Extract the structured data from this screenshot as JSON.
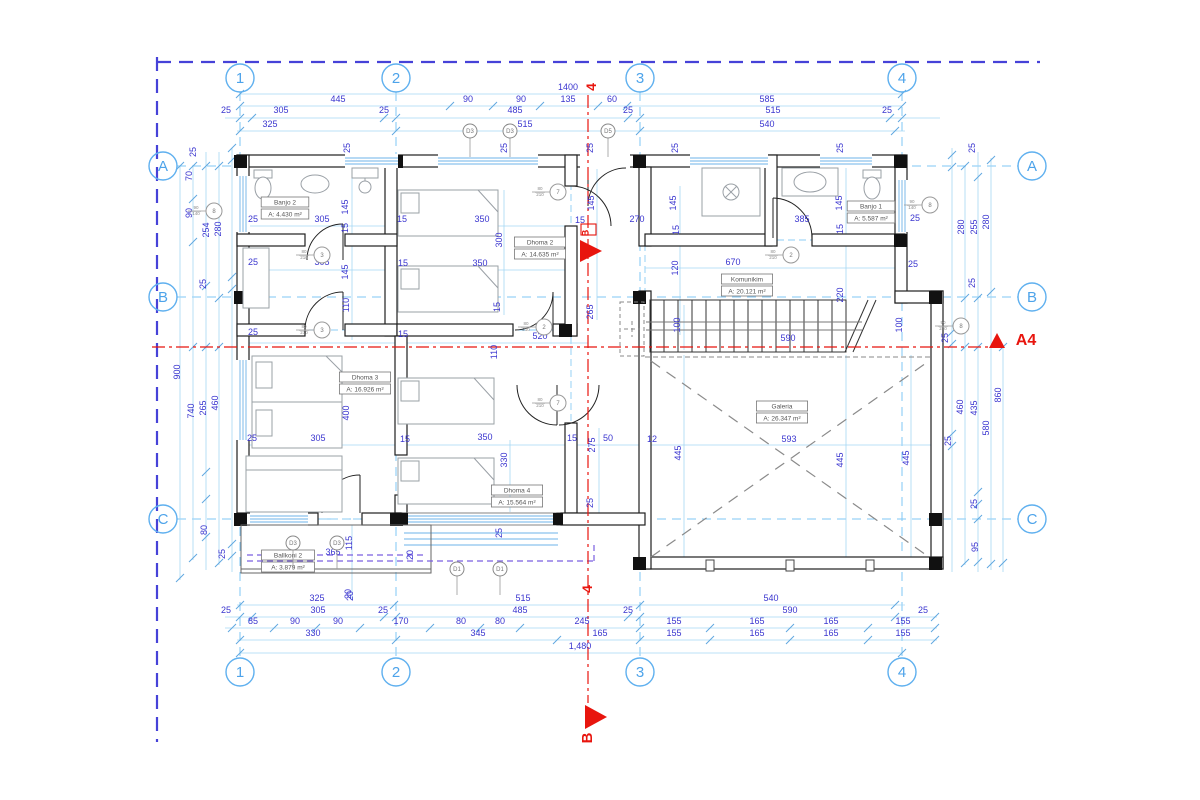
{
  "title": "First floor plan",
  "colors": {
    "dim_text": "#3a35cf",
    "grid_blue": "#5fb0ef",
    "light_blue": "#a5d7f4",
    "frame_blue": "#4642d8",
    "red": "#e8150e",
    "wall": "#1f1f1f",
    "furniture_gray": "#9aa0a6",
    "glass_blue": "#6db3e8",
    "balcony_purple": "#7a5fe0",
    "label_gray": "#555555"
  },
  "grid": {
    "cols": [
      {
        "label": "1",
        "x": 240
      },
      {
        "label": "2",
        "x": 396
      },
      {
        "label": "3",
        "x": 640
      },
      {
        "label": "4",
        "x": 902
      }
    ],
    "rows": [
      {
        "label": "A",
        "y": 166
      },
      {
        "label": "B",
        "y": 297
      },
      {
        "label": "C",
        "y": 519
      }
    ]
  },
  "rooms": [
    {
      "name": "Banjo 2",
      "area": "A: 4.430 m²",
      "cx": 285,
      "cy": 208
    },
    {
      "name": "Dhoma 2",
      "area": "A: 14.635 m²",
      "cx": 540,
      "cy": 248
    },
    {
      "name": "Banjo 1",
      "area": "A: 5.587 m²",
      "cx": 871,
      "cy": 212
    },
    {
      "name": "Komunikim",
      "area": "A: 20.121 m²",
      "cx": 747,
      "cy": 285
    },
    {
      "name": "Dhoma 3",
      "area": "A: 16.926 m²",
      "cx": 365,
      "cy": 383
    },
    {
      "name": "Dhoma 4",
      "area": "A: 15.564 m²",
      "cx": 517,
      "cy": 496
    },
    {
      "name": "Galeria",
      "area": "A: 26.347 m²",
      "cx": 782,
      "cy": 412
    },
    {
      "name": "Ballkoni 2",
      "area": "A: 3.879 m²",
      "cx": 288,
      "cy": 561
    }
  ],
  "dims": [
    [
      "1400",
      568,
      90,
      0
    ],
    [
      "445",
      338,
      102,
      0
    ],
    [
      "90",
      468,
      102,
      0
    ],
    [
      "90",
      521,
      102,
      0
    ],
    [
      "135",
      568,
      102,
      0
    ],
    [
      "60",
      612,
      102,
      0
    ],
    [
      "585",
      767,
      102,
      0
    ],
    [
      "25",
      226,
      113,
      0
    ],
    [
      "305",
      281,
      113,
      0
    ],
    [
      "25",
      384,
      113,
      0
    ],
    [
      "485",
      515,
      113,
      0
    ],
    [
      "25",
      628,
      113,
      0
    ],
    [
      "515",
      773,
      113,
      0
    ],
    [
      "25",
      887,
      113,
      0
    ],
    [
      "325",
      270,
      127,
      0
    ],
    [
      "515",
      525,
      127,
      0
    ],
    [
      "540",
      767,
      127,
      0
    ],
    [
      "25",
      350,
      148,
      1
    ],
    [
      "25",
      507,
      148,
      1
    ],
    [
      "25",
      593,
      148,
      1
    ],
    [
      "25",
      678,
      148,
      1
    ],
    [
      "25",
      843,
      148,
      1
    ],
    [
      "25",
      975,
      148,
      1
    ],
    [
      "25",
      196,
      152,
      1
    ],
    [
      "70",
      192,
      176,
      1
    ],
    [
      "90",
      192,
      213,
      1
    ],
    [
      "254",
      209,
      230,
      1
    ],
    [
      "280",
      221,
      229,
      1
    ],
    [
      "25",
      206,
      284,
      1
    ],
    [
      "900",
      180,
      372,
      1
    ],
    [
      "740",
      194,
      411,
      1
    ],
    [
      "265",
      206,
      408,
      1
    ],
    [
      "460",
      218,
      403,
      1
    ],
    [
      "80",
      207,
      530,
      1
    ],
    [
      "25",
      225,
      554,
      1
    ],
    [
      "280",
      964,
      227,
      1
    ],
    [
      "255",
      977,
      227,
      1
    ],
    [
      "280",
      989,
      222,
      1
    ],
    [
      "25",
      975,
      283,
      1
    ],
    [
      "100",
      902,
      325,
      1
    ],
    [
      "25",
      948,
      338,
      1
    ],
    [
      "860",
      1001,
      395,
      1
    ],
    [
      "460",
      963,
      407,
      1
    ],
    [
      "435",
      977,
      408,
      1
    ],
    [
      "580",
      989,
      428,
      1
    ],
    [
      "25",
      951,
      441,
      1
    ],
    [
      "25",
      977,
      504,
      1
    ],
    [
      "95",
      978,
      547,
      1
    ],
    [
      "25",
      253,
      222,
      0
    ],
    [
      "305",
      322,
      222,
      0
    ],
    [
      "25",
      253,
      265,
      0
    ],
    [
      "305",
      322,
      265,
      0
    ],
    [
      "25",
      253,
      335,
      0
    ],
    [
      "305",
      322,
      335,
      0
    ],
    [
      "145",
      348,
      207,
      1
    ],
    [
      "15",
      348,
      228,
      1
    ],
    [
      "145",
      348,
      272,
      1
    ],
    [
      "110",
      349,
      305,
      1
    ],
    [
      "15",
      402,
      222,
      0
    ],
    [
      "350",
      482,
      222,
      0
    ],
    [
      "300",
      502,
      240,
      1
    ],
    [
      "15",
      403,
      266,
      0
    ],
    [
      "350",
      480,
      266,
      0
    ],
    [
      "15",
      500,
      307,
      1
    ],
    [
      "15",
      403,
      337,
      0
    ],
    [
      "520",
      540,
      339,
      0
    ],
    [
      "145",
      594,
      203,
      1
    ],
    [
      "15",
      580,
      223,
      0
    ],
    [
      "270",
      637,
      222,
      0
    ],
    [
      "145",
      676,
      203,
      1
    ],
    [
      "15",
      679,
      230,
      1
    ],
    [
      "120",
      678,
      268,
      1
    ],
    [
      "670",
      733,
      265,
      0
    ],
    [
      "265",
      593,
      312,
      1
    ],
    [
      "145",
      842,
      203,
      1
    ],
    [
      "15",
      843,
      229,
      1
    ],
    [
      "385",
      802,
      222,
      0
    ],
    [
      "25",
      915,
      221,
      0
    ],
    [
      "25",
      913,
      267,
      0
    ],
    [
      "220",
      843,
      295,
      1
    ],
    [
      "100",
      680,
      325,
      1
    ],
    [
      "590",
      788,
      341,
      0
    ],
    [
      "400",
      349,
      413,
      1
    ],
    [
      "25",
      252,
      441,
      0
    ],
    [
      "305",
      318,
      441,
      0
    ],
    [
      "15",
      405,
      442,
      0
    ],
    [
      "350",
      485,
      440,
      0
    ],
    [
      "110",
      497,
      352,
      1
    ],
    [
      "330",
      507,
      460,
      1
    ],
    [
      "15",
      572,
      441,
      0
    ],
    [
      "50",
      608,
      441,
      0
    ],
    [
      "275",
      595,
      445,
      1
    ],
    [
      "12",
      652,
      442,
      0
    ],
    [
      "445",
      681,
      453,
      1
    ],
    [
      "25",
      593,
      503,
      1
    ],
    [
      "25",
      502,
      533,
      1
    ],
    [
      "593",
      789,
      442,
      0
    ],
    [
      "445",
      843,
      460,
      1
    ],
    [
      "445",
      909,
      458,
      1
    ],
    [
      "365",
      333,
      555,
      0
    ],
    [
      "115",
      352,
      543,
      1
    ],
    [
      "20",
      413,
      555,
      1
    ],
    [
      "20",
      353,
      596,
      1
    ],
    [
      "325",
      317,
      601,
      0
    ],
    [
      "20",
      351,
      594,
      1
    ],
    [
      "515",
      523,
      601,
      0
    ],
    [
      "540",
      771,
      601,
      0
    ],
    [
      "25",
      226,
      613,
      0
    ],
    [
      "305",
      318,
      613,
      0
    ],
    [
      "25",
      383,
      613,
      0
    ],
    [
      "485",
      520,
      613,
      0
    ],
    [
      "25",
      628,
      613,
      0
    ],
    [
      "590",
      790,
      613,
      0
    ],
    [
      "25",
      923,
      613,
      0
    ],
    [
      "85",
      253,
      624,
      0
    ],
    [
      "90",
      295,
      624,
      0
    ],
    [
      "90",
      338,
      624,
      0
    ],
    [
      "170",
      401,
      624,
      0
    ],
    [
      "80",
      461,
      624,
      0
    ],
    [
      "80",
      500,
      624,
      0
    ],
    [
      "245",
      582,
      624,
      0
    ],
    [
      "155",
      674,
      624,
      0
    ],
    [
      "165",
      757,
      624,
      0
    ],
    [
      "165",
      831,
      624,
      0
    ],
    [
      "155",
      903,
      624,
      0
    ],
    [
      "330",
      313,
      636,
      0
    ],
    [
      "345",
      478,
      636,
      0
    ],
    [
      "165",
      600,
      636,
      0
    ],
    [
      "155",
      674,
      636,
      0
    ],
    [
      "165",
      757,
      636,
      0
    ],
    [
      "165",
      831,
      636,
      0
    ],
    [
      "155",
      903,
      636,
      0
    ],
    [
      "1,480",
      580,
      649,
      0
    ]
  ],
  "window_tags": [
    {
      "label": "D3",
      "x": 470,
      "y": 131
    },
    {
      "label": "D3",
      "x": 510,
      "y": 131
    },
    {
      "label": "D5",
      "x": 608,
      "y": 131
    },
    {
      "label": "D3",
      "x": 293,
      "y": 543
    },
    {
      "label": "D3",
      "x": 337,
      "y": 543
    },
    {
      "label": "D1",
      "x": 457,
      "y": 569
    },
    {
      "label": "D1",
      "x": 500,
      "y": 569
    }
  ],
  "door_tags": [
    {
      "label": "8",
      "x": 214,
      "y": 211,
      "size": "90|140"
    },
    {
      "label": "3",
      "x": 322,
      "y": 255,
      "size": "80|210"
    },
    {
      "label": "3",
      "x": 322,
      "y": 330,
      "size": "80|210"
    },
    {
      "label": "7",
      "x": 558,
      "y": 192,
      "size": "80|210"
    },
    {
      "label": "2",
      "x": 544,
      "y": 327,
      "size": "80|210"
    },
    {
      "label": "2",
      "x": 791,
      "y": 255,
      "size": "80|210"
    },
    {
      "label": "8",
      "x": 930,
      "y": 205,
      "size": "90|140"
    },
    {
      "label": "7",
      "x": 558,
      "y": 403,
      "size": "80|210"
    },
    {
      "label": "8",
      "x": 961,
      "y": 326,
      "size": "90|240"
    }
  ],
  "section_markers": {
    "top_label": "4",
    "bottom_label": "4",
    "cut_mid_label": "B",
    "cut_bottom_label": "B",
    "detail_label": "A4"
  }
}
